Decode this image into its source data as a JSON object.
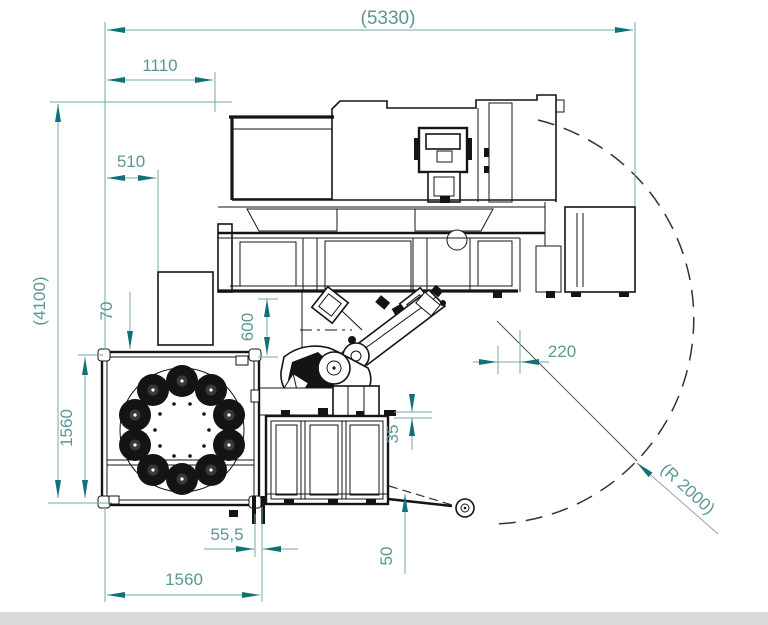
{
  "drawing": {
    "type": "machine-floorplan-top-view",
    "colors": {
      "background": "#ffffff",
      "dimension_line": "#74aaa6",
      "dimension_text": "#5a9793",
      "arrow": "#0e7276",
      "drawing_line": "#141414",
      "footer_strip": "#d9d9d9"
    },
    "dimensions": {
      "overall_width": "(5330)",
      "offset_1110": "1110",
      "offset_510": "510",
      "overall_depth": "(4100)",
      "gap_70": "70",
      "gap_600": "600",
      "pallet_depth_1560": "1560",
      "offset_220": "220",
      "gap_35": "35",
      "swing_radius": "(R 2000)",
      "gap_55_5": "55,5",
      "gap_50": "50",
      "pallet_width_1560": "1560"
    }
  }
}
